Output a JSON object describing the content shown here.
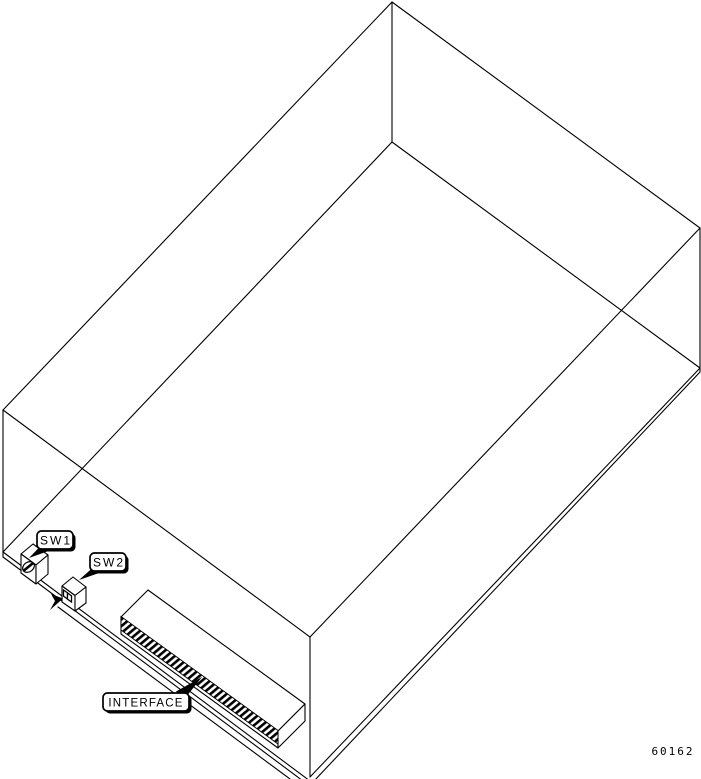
{
  "illustration": {
    "title": "Chassis bottom view line drawing",
    "background_color": "#ffffff",
    "line_color": "#000000",
    "callouts": [
      {
        "id": "sw1",
        "label": "SW1"
      },
      {
        "id": "sw2",
        "label": "SW2"
      },
      {
        "id": "interface",
        "label": "INTERFACE"
      }
    ],
    "figure_number": "60162"
  }
}
